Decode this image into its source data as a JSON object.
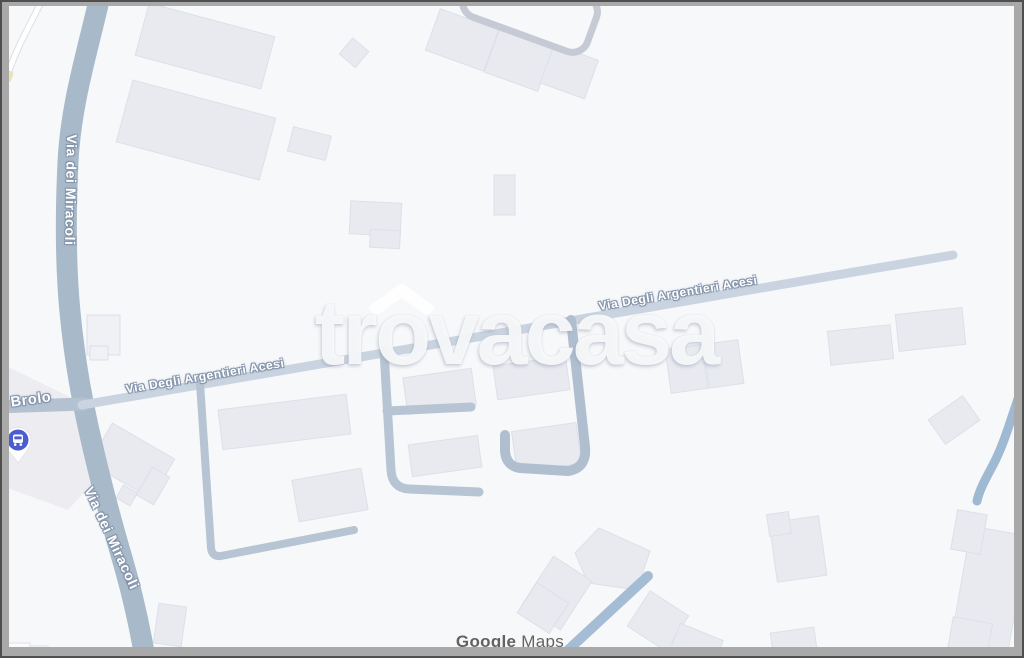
{
  "map": {
    "type": "google-maps-embed-screenshot",
    "road_labels": {
      "via_dei_miracoli_top": "Via dei Miracoli",
      "via_dei_miracoli_bottom": "Via dei Miracoli",
      "brolo": "Brolo",
      "via_degli_argentieri_acesi_1": "Via Degli Argentieri Acesi",
      "via_degli_argentieri_acesi_2": "Via Degli Argentieri Acesi"
    },
    "markers": {
      "transit_pin": "bus-stop"
    },
    "icons": {
      "one_way_arrow": "↑"
    },
    "watermark": {
      "full_text": "trovacasa",
      "prefix": "tr",
      "roof_letter": "o",
      "suffix": "vacasa"
    },
    "attribution": {
      "google": "Google",
      "maps": "Maps"
    },
    "palette": {
      "map_background": "#f7f8fa",
      "building_fill": "#e8eaf0",
      "building_border": "#dde0e9",
      "road_major": "#a8bac9",
      "road_secondary": "#b3c1d1",
      "road_minor": "#b7c4d3",
      "road_tertiary": "#c9d4e0",
      "road_blue": "#a5bdd4",
      "label_halo": "#8494ab",
      "pin_blue": "#4a5ed1",
      "frame_gray": "#a9a9a9",
      "frame_edge": "#4f4f4f",
      "attribution_gray": "#626262",
      "watermark_white": "rgba(255,255,255,0.86)"
    }
  }
}
